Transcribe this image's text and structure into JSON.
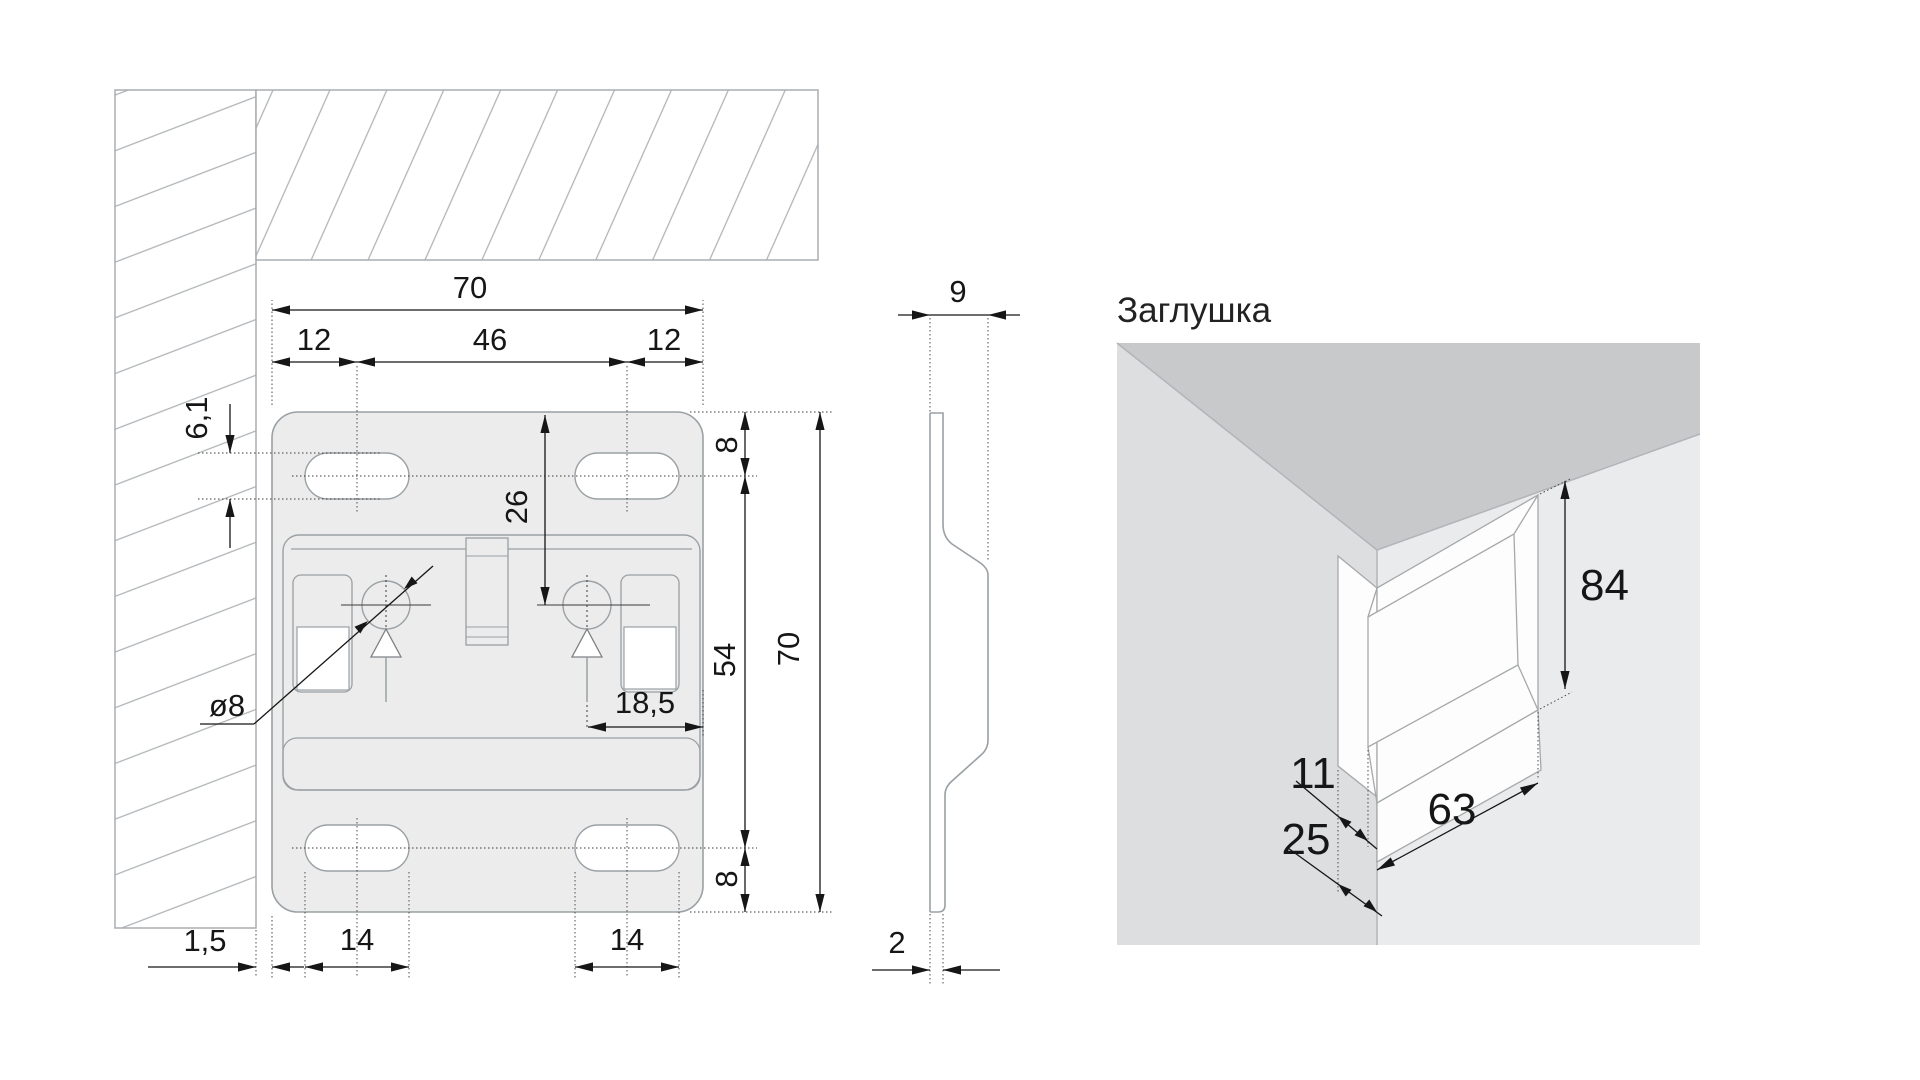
{
  "drawing": {
    "front_view": {
      "dims": {
        "total_width": "70",
        "left_slot_offset": "12",
        "slot_span": "46",
        "right_slot_offset": "12",
        "slot_height": "6,1",
        "hole_center_from_top": "26",
        "top_slot_from_top": "8",
        "slot_centers_span": "54",
        "total_height": "70",
        "hole_to_edge": "18,5",
        "hole_diameter": "ø8",
        "wall_gap": "1,5",
        "bottom_slot_width_left": "14",
        "bottom_slot_width_right": "14",
        "bottom_slot_from_bottom": "8"
      }
    },
    "side_view": {
      "dims": {
        "depth": "9",
        "plate_thickness": "2"
      }
    },
    "cap_view": {
      "label": "Заглушка",
      "dims": {
        "height": "84",
        "corner_offset": "11",
        "corner_depth": "25",
        "width": "63"
      }
    },
    "colors": {
      "plate_fill": "#ececec",
      "ceiling_3d": "#c7c9cb",
      "wall_left_3d": "#dcdee0",
      "wall_right_3d": "#e9ebec",
      "cap_fill": "#fdfdfd",
      "outline": "#9aa0a4",
      "dimension": "#161616"
    }
  }
}
